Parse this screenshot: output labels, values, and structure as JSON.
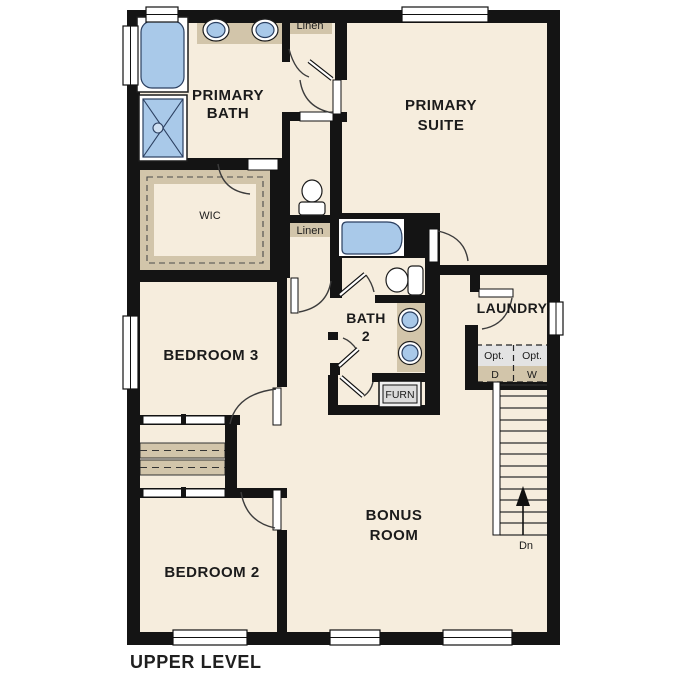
{
  "title": "UPPER LEVEL",
  "rooms": {
    "primary_bath": {
      "line1": "PRIMARY",
      "line2": "BATH"
    },
    "primary_suite": {
      "line1": "PRIMARY",
      "line2": "SUITE"
    },
    "wic": "WIC",
    "bedroom3": "BEDROOM 3",
    "bath2": {
      "line1": "BATH",
      "line2": "2"
    },
    "laundry": "LAUNDRY",
    "bonus_room": {
      "line1": "BONUS",
      "line2": "ROOM"
    },
    "bedroom2": "BEDROOM 2"
  },
  "labels": {
    "linen": "Linen",
    "furnace": "FURN",
    "opt": "Opt.",
    "dryer": "D",
    "washer": "W",
    "stairs_down": "Dn"
  },
  "colors": {
    "floor": "#f6eddd",
    "wall": "#141414",
    "cabinet_tan": "#d2c5aa",
    "fixture_blue": "#a9c9e9",
    "appliance_grey": "#e3e3e3"
  }
}
